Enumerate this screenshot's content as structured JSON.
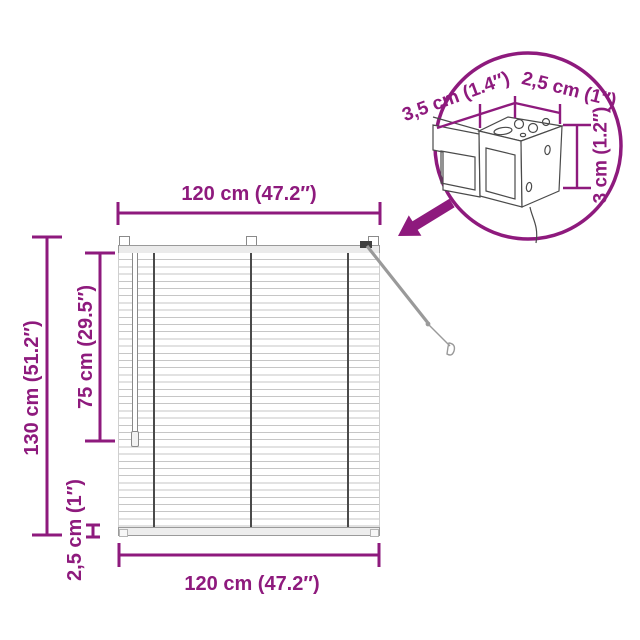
{
  "product": "venetian-blind-dimension-diagram",
  "colors": {
    "accent": "#8e1a7d",
    "background": "#ffffff",
    "sketch_line": "#4a4a4a",
    "blind_slat_line": "#c6c6c6",
    "cord": "#4a4a4a"
  },
  "dimensions": {
    "width_top": "120 cm (47.2″)",
    "width_bottom": "120 cm (47.2″)",
    "height_total": "130 cm (51.2″)",
    "cord_length": "75 cm (29.5″)",
    "bottom_rail_height": "2,5 cm (1″)",
    "headrail_depth": "3,5 cm (1.4″)",
    "headrail_width": "2,5 cm (1″)",
    "headrail_height": "3 cm (1.2″)"
  }
}
